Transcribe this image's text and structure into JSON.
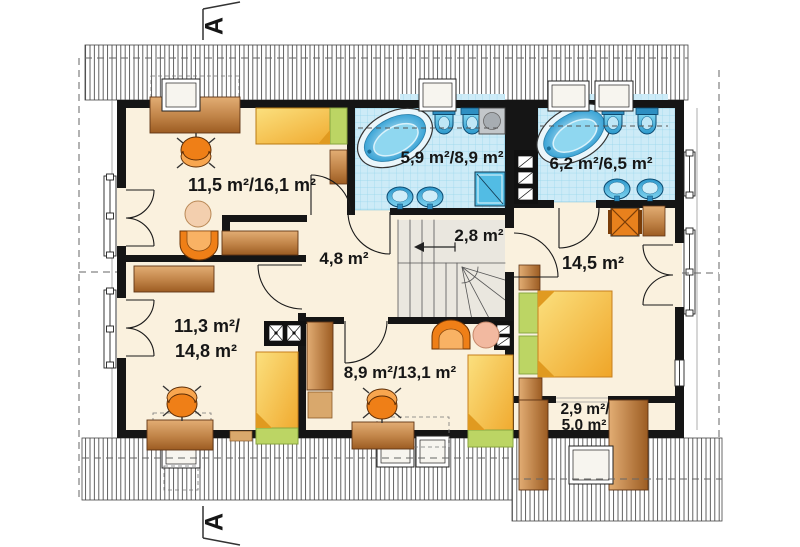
{
  "plan": {
    "section_marker": "A",
    "rooms": {
      "top_left": "11,5 m²/16,1 m²",
      "bath_left": "5,9 m²/8,9 m²",
      "bath_right": "6,2 m²/6,5 m²",
      "hall": "4,8 m²",
      "stair": "2,8 m²",
      "bedroom_right": "14,5 m²",
      "bottom_left_line1": "11,3 m²/",
      "bottom_left_line2": "14,8 m²",
      "bottom_middle": "8,9 m²/13,1 m²",
      "storage_line1": "2,9 m²/",
      "storage_line2": "5,0 m²"
    },
    "colors": {
      "floor": "#faf1de",
      "wall": "#151515",
      "tile": "#cdebf7",
      "tile_grid": "#96d6ec",
      "fixture_blue": "#3fa9dc",
      "furniture_brown": "#c08347",
      "chair_orange": "#ef7f17",
      "bed_yellow": "#f5c33c",
      "bed_green": "#bcd564"
    }
  }
}
